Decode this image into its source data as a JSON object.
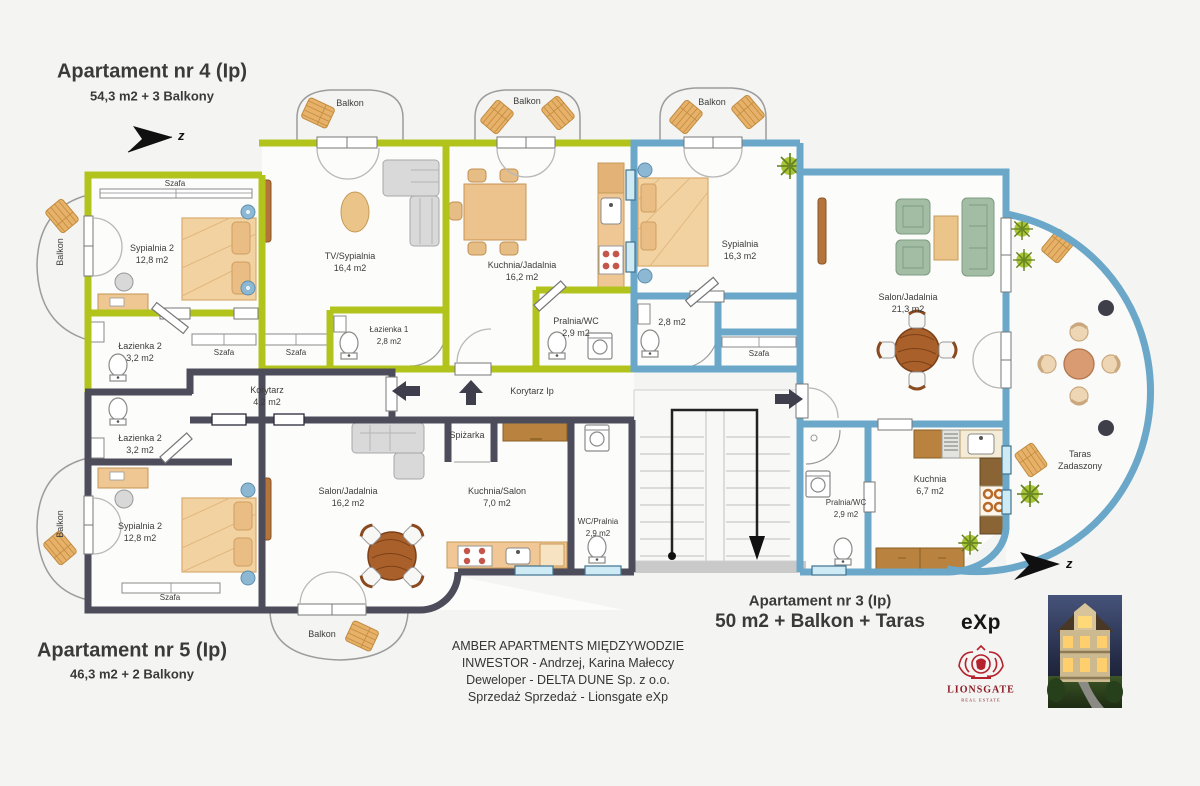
{
  "titles": {
    "apt4": {
      "name": "Apartament nr 4 (Ip)",
      "size": "54,3 m2 + 3 Balkony"
    },
    "apt5": {
      "name": "Apartament nr 5 (Ip)",
      "size": "46,3 m2 + 2 Balkony"
    },
    "apt3": {
      "name": "Apartament nr 3 (Ip)",
      "size": "50 m2 + Balkon + Taras"
    }
  },
  "compass": {
    "label": "z"
  },
  "colors": {
    "apt4_wall": "#b2c41c",
    "apt5_wall": "#4c4c5a",
    "apt3_wall": "#6aa7c8"
  },
  "rooms": {
    "apt4_sypialnia2": {
      "name": "Sypialnia 2",
      "area": "12,8 m2"
    },
    "apt4_lazienka2": {
      "name": "Łazienka 2",
      "area": "3,2 m2"
    },
    "apt4_tv_sypialnia": {
      "name": "TV/Sypialnia",
      "area": "16,4 m2"
    },
    "apt4_lazienka1": {
      "name": "Łazienka 1",
      "area": "2,8 m2"
    },
    "apt4_kuchnia_jadalnia": {
      "name": "Kuchnia/Jadalnia",
      "area": "16,2 m2"
    },
    "apt4_pralnia_wc": {
      "name": "Pralnia/WC",
      "area": "2,9 m2"
    },
    "apt3_sypialnia": {
      "name": "Sypialnia",
      "area": "16,3 m2"
    },
    "apt3_lazienka2": {
      "name": "Łazienka 2",
      "area": "2,8 m2"
    },
    "apt3_salon_jadalnia": {
      "name": "Salon/Jadalnia",
      "area": "21,3 m2"
    },
    "apt3_kuchnia": {
      "name": "Kuchnia",
      "area": "6,7 m2"
    },
    "apt3_pralnia_wc": {
      "name": "Pralnia/WC",
      "area": "2,9 m2"
    },
    "apt5_korytarz": {
      "name": "Korytarz",
      "area": "4,2 m2"
    },
    "apt5_lazienka2": {
      "name": "Łazienka 2",
      "area": "3,2 m2"
    },
    "apt5_sypialnia2": {
      "name": "Sypialnia 2",
      "area": "12,8 m2"
    },
    "apt5_salon_jadalnia": {
      "name": "Salon/Jadalnia",
      "area": "16,2 m2"
    },
    "apt5_spizarka": {
      "name": "Spiżarka"
    },
    "apt5_kuchnia_salon": {
      "name": "Kuchnia/Salon",
      "area": "7,0 m2"
    },
    "apt5_wc_pralnia": {
      "name": "WC/Pralnia",
      "area": "2,9 m2"
    },
    "korytarz_ip": {
      "name": "Korytarz Ip"
    }
  },
  "labels": {
    "balkon": "Balkon",
    "szafa": "Szafa",
    "taras_line1": "Taras",
    "taras_line2": "Zadaszony"
  },
  "footer": {
    "line1": "AMBER APARTMENTS MIĘDZYWODZIE",
    "line2": "INWESTOR - Andrzej, Karina Małeccy",
    "line3": "Deweloper - DELTA DUNE Sp. z o.o.",
    "line4": "Sprzedaż Sprzedaż - Lionsgate eXp"
  },
  "logos": {
    "exp": "eXp",
    "lionsgate": "LIONSGATE",
    "lionsgate_sub": "REAL ESTATE"
  }
}
